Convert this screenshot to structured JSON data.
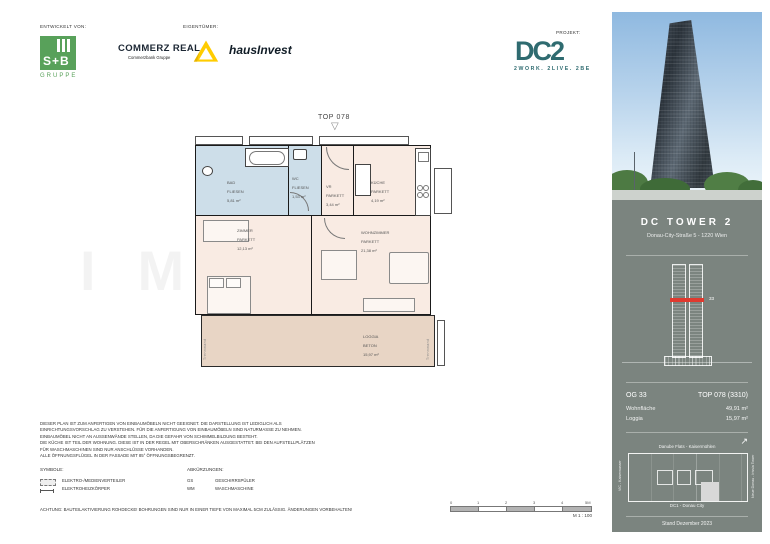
{
  "header": {
    "developed_label": "ENTWICKELT VON:",
    "owner_label": "EIGENTÜMER:",
    "project_label": "PROJEKT:",
    "sb": {
      "name": "S+B",
      "sub": "GRUPPE"
    },
    "commerz": {
      "name": "COMMERZ REAL",
      "sub": "Commerzbank Gruppe"
    },
    "hausinvest": "hausInvest",
    "dc2": {
      "name": "DC2",
      "tagline": "2WORK. 2LIVE. 2BE"
    }
  },
  "plan": {
    "unit_label": "TOP 078",
    "entrance_marker": "▽",
    "watermark": "IMMO",
    "trennwand_left": "Trennwand",
    "trennwand_right": "Trennwand",
    "rooms": {
      "bad": {
        "name": "BAD",
        "floor": "FLIESEN",
        "area": "5,81 m²"
      },
      "wc": {
        "name": "WC",
        "floor": "FLIESEN",
        "area": "1,53 m²"
      },
      "vr": {
        "name": "VR",
        "floor": "PARKETT",
        "area": "3,44 m²"
      },
      "kueche": {
        "name": "KÜCHE",
        "floor": "PARKETT",
        "area": "4,19 m²"
      },
      "zimmer": {
        "name": "ZIMMER",
        "floor": "PARKETT",
        "area": "12,13 m²"
      },
      "wohnzimmer": {
        "name": "WOHNZIMMER",
        "floor": "PARKETT",
        "area": "21,38 m²"
      },
      "loggia": {
        "name": "LOGGIA",
        "floor": "BETON",
        "area": "15,97 m²"
      }
    }
  },
  "notes": [
    "DIESER PLAN IST ZUM ANFERTIGEN VON EINBAUMÖBELN NICHT GEEIGNET. DIE DARSTELLUNG IST LEDIGLICH ALS",
    "EINRICHTUNGSVORSCHLAG ZU VERSTEHEN. FÜR DIE ANFERTIGUNG VON EINBAUMÖBELN SIND NATURMASSE ZU NEHMEN.",
    "EINBAUMÖBEL NICHT AN AUSSENWÄNDE STELLEN, DA DIE GEFAHR VON SCHIMMELBILDUNG BESTEHT.",
    "DIE KÜCHE IST TEIL DER WOHNUNG. DIESE IST IN DER REGEL MIT OBERSCHRÄNKEN AUSGESTATTET. BEI DEN AUFSTELLPLÄTZEN",
    "FÜR WASCHMASCHINEN SIND NUR ANSCHLÜSSE VORHANDEN.",
    "ALLE ÖFFNUNGSFLÜGEL IN DER FASSADE MIT 85° ÖFFNUNGSBEGRENZT."
  ],
  "legend": {
    "symbols_label": "SYMBOLE:",
    "abbr_label": "ABKÜRZUNGEN:",
    "symbols": [
      {
        "label": "ELEKTRO-/MEDIENVERTEILER"
      },
      {
        "label": "ELEKTROHEIZKÖRPER"
      }
    ],
    "abbreviations": [
      {
        "abbr": "GS",
        "label": "GESCHIRRSPÜLER"
      },
      {
        "abbr": "WM",
        "label": "WASCHMASCHINE"
      }
    ]
  },
  "caution": "ACHTUNG: BAUTEILAKTIVIERUNG ROHDECKE! BOHRUNGEN SIND NUR IN EINER TIEFE VON MAXIMAL 5CM ZULÄSSIG. ÄNDERUNGEN VORBEHALTEN!",
  "scalebar": {
    "ticks": [
      "0",
      "1",
      "2",
      "3",
      "4",
      "5M"
    ],
    "scale": "M 1 : 100"
  },
  "sidebar": {
    "title": "DC TOWER 2",
    "address": "Donau-City-Straße 5 - 1220 Wien",
    "floor_marker": "33",
    "north_icon": "↗",
    "unit": {
      "floor": "OG 33",
      "top": "TOP 078 (3310)"
    },
    "areas": [
      {
        "label": "Wohnfläche",
        "value": "49,91 m²"
      },
      {
        "label": "Loggia",
        "value": "15,97 m²"
      }
    ],
    "siteplan": {
      "top": "Danube Flats - Kaisermühlen",
      "left": "VIC - Kaiserwasser",
      "right": "Neue Donau - Irissia Tower",
      "bottom": "DC1 - Donau City"
    },
    "stand": "Stand Dezember 2023"
  },
  "colors": {
    "accent_red": "#e0392e",
    "panel_gray": "#7b847f",
    "dc2_teal": "#2f6b70",
    "sb_green": "#58a15a",
    "commerz_yellow": "#ffcc00",
    "wet_blue": "#cdditto"
  }
}
